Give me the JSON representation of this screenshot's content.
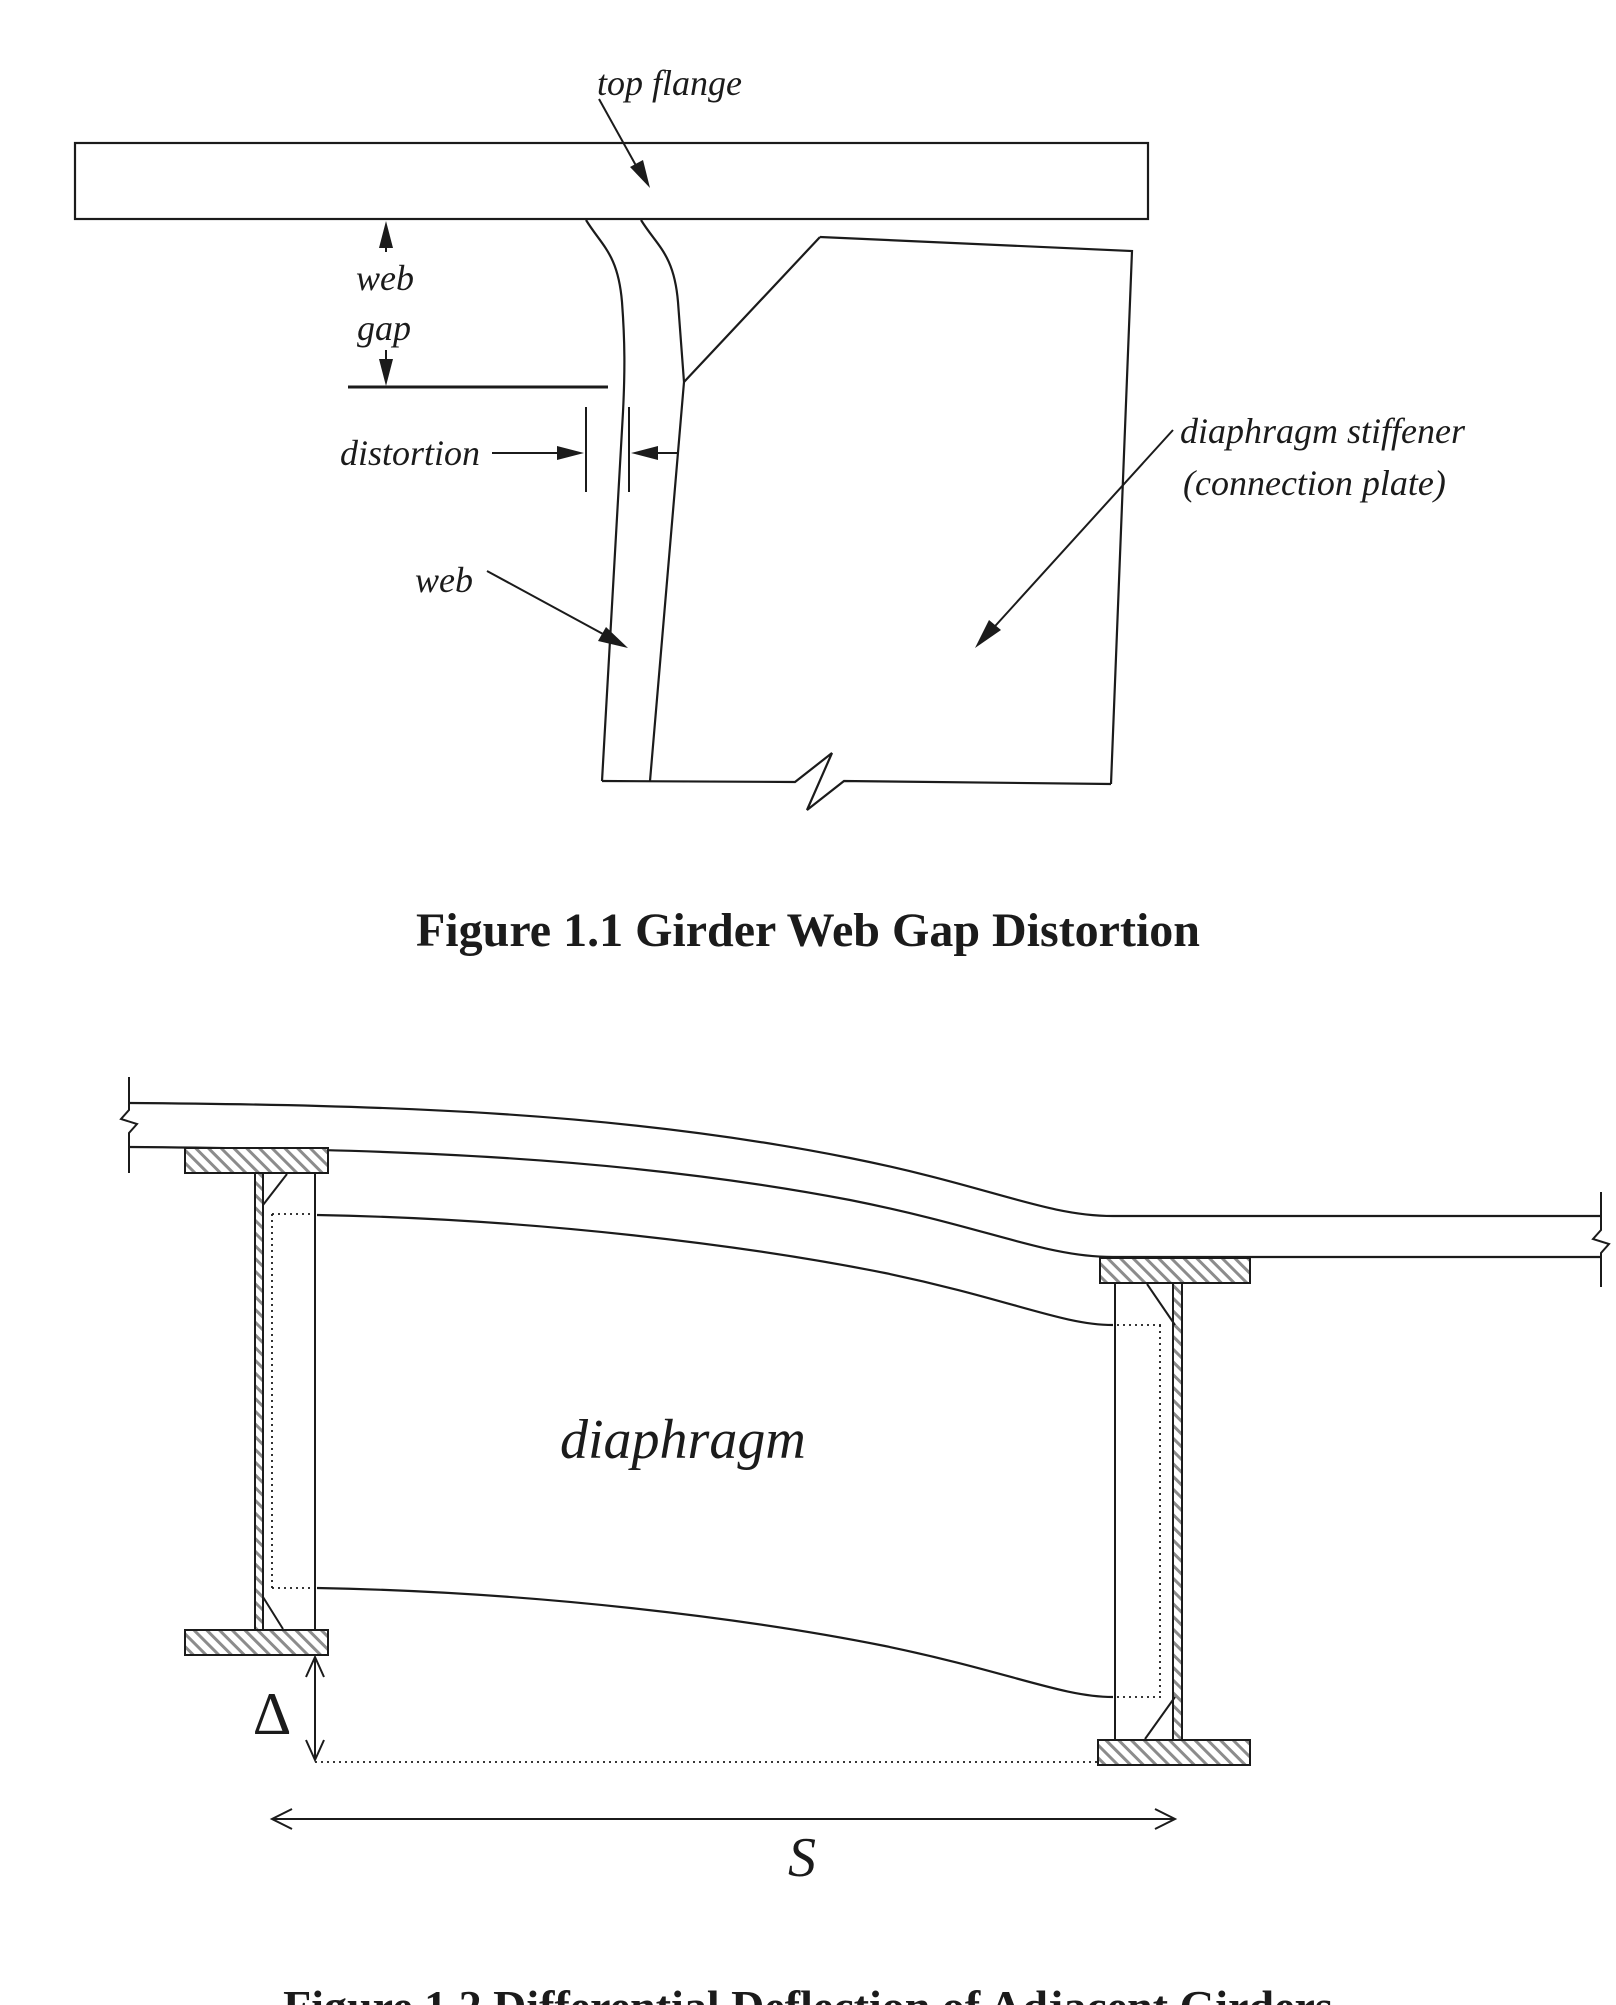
{
  "page": {
    "background": "#ffffff",
    "ink": "#1b1b1b",
    "hatch": "#8c8c8c"
  },
  "figure1": {
    "caption": "Figure 1.1 Girder Web Gap Distortion",
    "labels": {
      "top_flange": "top flange",
      "web_gap_word1": "web",
      "web_gap_word2": "gap",
      "distortion": "distortion",
      "web": "web",
      "stiffener_line1": "diaphragm stiffener",
      "stiffener_line2": "(connection plate)"
    }
  },
  "figure2": {
    "caption": "Figure 1.2 Differential Deflection of Adjacent Girders",
    "labels": {
      "diaphragm": "diaphragm",
      "delta_symbol": "Δ",
      "girder_spacing": "S"
    }
  }
}
